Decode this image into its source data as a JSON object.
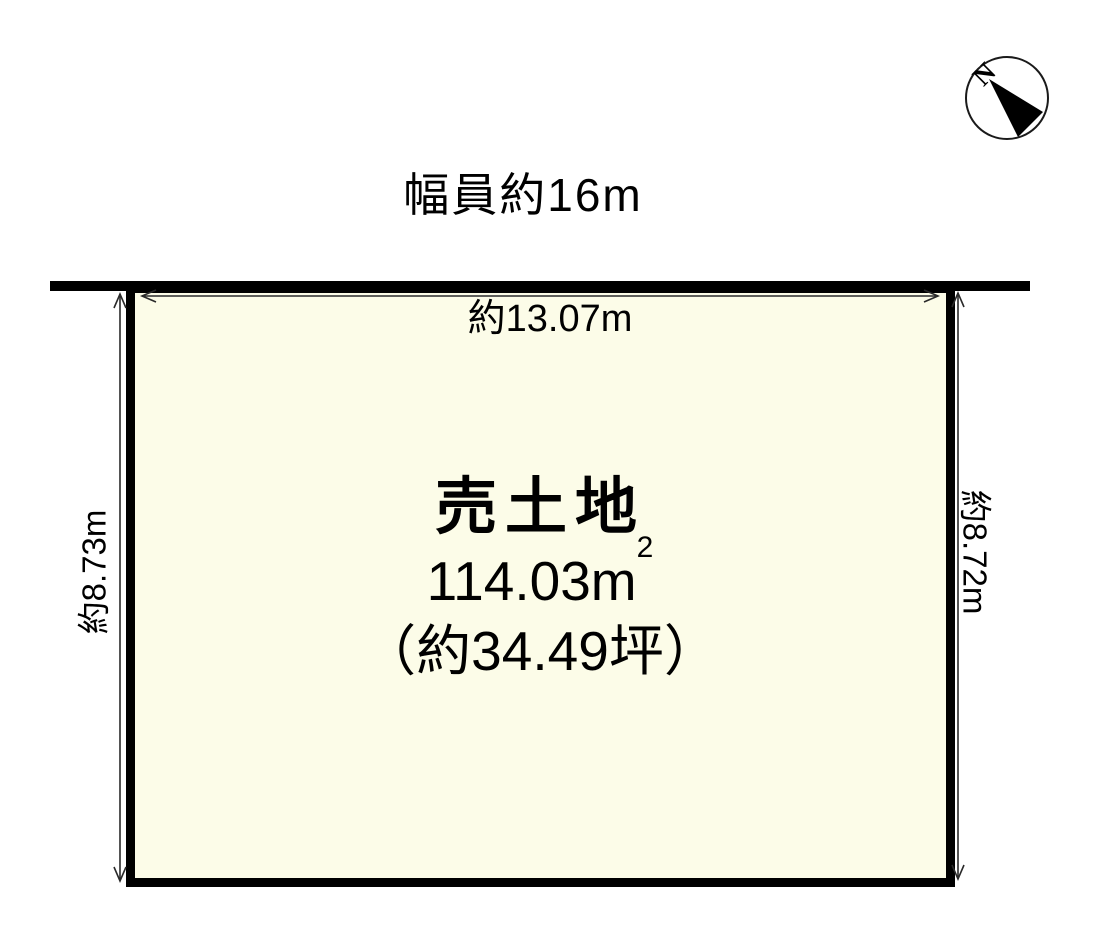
{
  "diagram": {
    "kind": "land-parcel-plot",
    "road": {
      "width_label": "幅員約16m"
    },
    "dimensions": {
      "top": "約13.07m",
      "left": "約8.73m",
      "right": "約8.72m"
    },
    "parcel": {
      "title": "売土地",
      "area_sqm_base": "114.03m",
      "area_sqm_sup": "2",
      "area_tsubo": "（約34.49坪）"
    },
    "compass": {
      "label": "N"
    },
    "colors": {
      "parcel_fill": "#FCFCE8",
      "outline": "#000000",
      "dimension_line": "#2a2a2a"
    }
  }
}
